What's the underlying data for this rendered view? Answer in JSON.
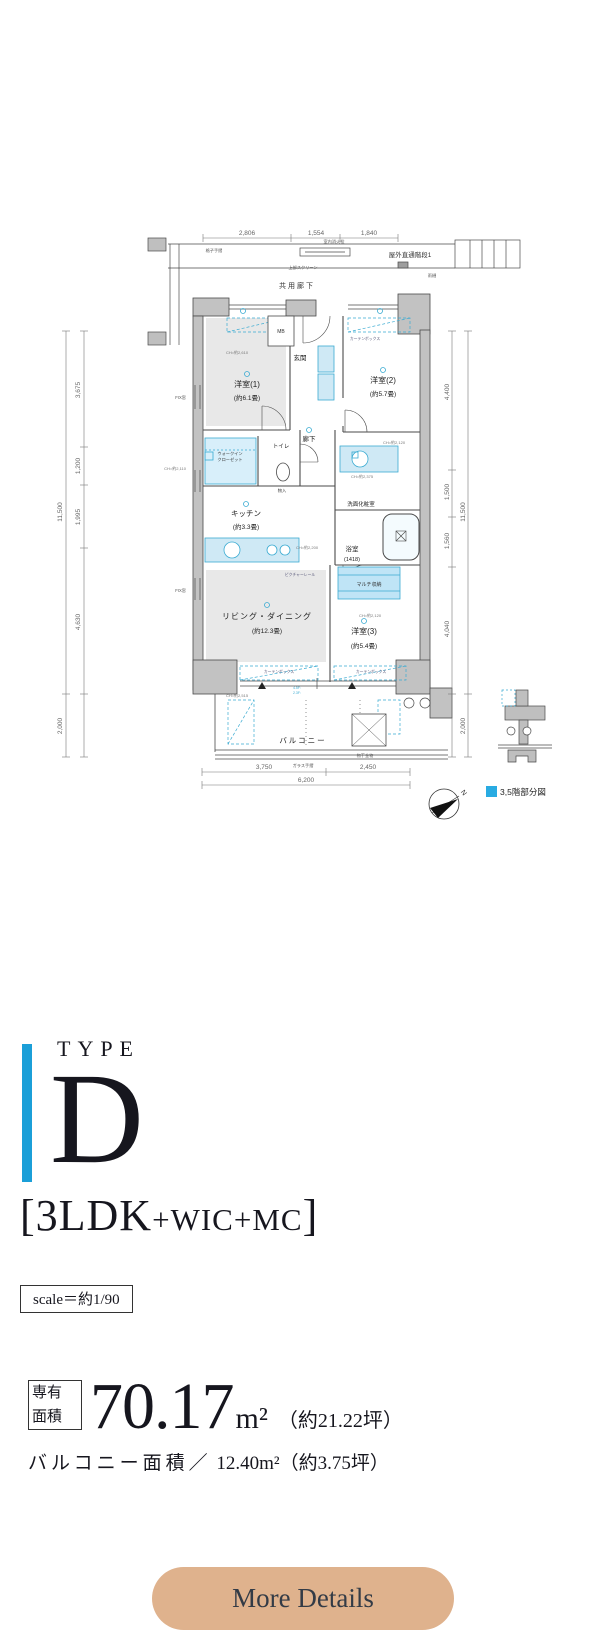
{
  "colors": {
    "accent": "#1b9fd8",
    "plan_cyan": "#3aabd2",
    "plan_cyan_fill": "#cfe9f5",
    "wall": "#c2c2c2",
    "wall_stroke": "#4a4a4a",
    "room_fill": "#e8e8e8",
    "dim_text": "#666666",
    "button": "#dfb28d",
    "button_text": "#333b46",
    "legend_square": "#29abe2"
  },
  "plan": {
    "texts": [
      {
        "x": 247,
        "y": 235,
        "t": "2,806",
        "s": 6.5,
        "c": "#666",
        "n": "dim-top-1"
      },
      {
        "x": 316,
        "y": 235,
        "t": "1,554",
        "s": 6.5,
        "c": "#666",
        "n": "dim-top-2"
      },
      {
        "x": 369,
        "y": 235,
        "t": "1,840",
        "s": 6.5,
        "c": "#666",
        "n": "dim-top-3"
      },
      {
        "x": 62,
        "y": 512,
        "t": "11,500",
        "s": 6.5,
        "c": "#666",
        "r": -90,
        "n": "dim-left-total"
      },
      {
        "x": 80,
        "y": 390,
        "t": "3,675",
        "s": 6.5,
        "c": "#666",
        "r": -90,
        "n": "dim-left-1"
      },
      {
        "x": 80,
        "y": 466,
        "t": "1,200",
        "s": 6.5,
        "c": "#666",
        "r": -90,
        "n": "dim-left-2"
      },
      {
        "x": 80,
        "y": 517,
        "t": "1,995",
        "s": 6.5,
        "c": "#666",
        "r": -90,
        "n": "dim-left-3"
      },
      {
        "x": 80,
        "y": 622,
        "t": "4,630",
        "s": 6.5,
        "c": "#666",
        "r": -90,
        "n": "dim-left-4"
      },
      {
        "x": 62,
        "y": 726,
        "t": "2,000",
        "s": 6.5,
        "c": "#666",
        "r": -90,
        "n": "dim-left-5"
      },
      {
        "x": 449,
        "y": 392,
        "t": "4,400",
        "s": 6.5,
        "c": "#666",
        "r": -90,
        "n": "dim-right-1"
      },
      {
        "x": 449,
        "y": 492,
        "t": "1,500",
        "s": 6.5,
        "c": "#666",
        "r": -90,
        "n": "dim-right-2"
      },
      {
        "x": 449,
        "y": 541,
        "t": "1,560",
        "s": 6.5,
        "c": "#666",
        "r": -90,
        "n": "dim-right-3"
      },
      {
        "x": 449,
        "y": 629,
        "t": "4,040",
        "s": 6.5,
        "c": "#666",
        "r": -90,
        "n": "dim-right-4"
      },
      {
        "x": 465,
        "y": 512,
        "t": "11,500",
        "s": 6.5,
        "c": "#666",
        "r": -90,
        "n": "dim-right-total"
      },
      {
        "x": 465,
        "y": 726,
        "t": "2,000",
        "s": 6.5,
        "c": "#666",
        "r": -90,
        "n": "dim-right-5"
      },
      {
        "x": 264,
        "y": 769,
        "t": "3,750",
        "s": 6.5,
        "c": "#666",
        "n": "dim-bottom-1"
      },
      {
        "x": 368,
        "y": 769,
        "t": "2,450",
        "s": 6.5,
        "c": "#666",
        "n": "dim-bottom-2"
      },
      {
        "x": 306,
        "y": 782,
        "t": "6,200",
        "s": 6.5,
        "c": "#666",
        "n": "dim-bottom-total"
      },
      {
        "x": 410,
        "y": 257,
        "t": "屋外直通階段1",
        "s": 6.5,
        "c": "#333",
        "n": "label-outdoor-stairs"
      },
      {
        "x": 297,
        "y": 288,
        "t": "共用廊下",
        "s": 7,
        "c": "#333",
        "ls": 2,
        "n": "label-common-corridor"
      },
      {
        "x": 303,
        "y": 269,
        "t": "上部スクリーン",
        "s": 4.2,
        "c": "#555",
        "n": "label-upper-screen"
      },
      {
        "x": 214,
        "y": 252,
        "t": "格子手摺",
        "s": 4.2,
        "c": "#555",
        "n": "label-lattice-rail"
      },
      {
        "x": 334,
        "y": 243,
        "t": "室内消火栓",
        "s": 4.2,
        "c": "#555",
        "n": "label-hydrant"
      },
      {
        "x": 432,
        "y": 277,
        "t": "雨樋",
        "s": 4.2,
        "c": "#555",
        "n": "label-gutter"
      },
      {
        "x": 281,
        "y": 333,
        "t": "MB",
        "s": 5,
        "c": "#333",
        "n": "label-mb"
      },
      {
        "x": 247,
        "y": 387,
        "t": "洋室(1)",
        "s": 8,
        "c": "#222",
        "n": "label-bedroom1"
      },
      {
        "x": 247,
        "y": 400,
        "t": "(約6.1畳)",
        "s": 6.5,
        "c": "#222",
        "n": "label-bedroom1-size"
      },
      {
        "x": 383,
        "y": 383,
        "t": "洋室(2)",
        "s": 8,
        "c": "#222",
        "n": "label-bedroom2"
      },
      {
        "x": 383,
        "y": 396,
        "t": "(約5.7畳)",
        "s": 6.5,
        "c": "#222",
        "n": "label-bedroom2-size"
      },
      {
        "x": 300,
        "y": 360,
        "t": "玄関",
        "s": 6.5,
        "c": "#222",
        "n": "label-entrance"
      },
      {
        "x": 309,
        "y": 441,
        "t": "廊下",
        "s": 6.5,
        "c": "#222",
        "n": "label-hallway"
      },
      {
        "x": 281,
        "y": 448,
        "t": "トイレ",
        "s": 5.5,
        "c": "#222",
        "n": "label-toilet"
      },
      {
        "x": 230,
        "y": 455,
        "t": "ウォークイン",
        "s": 4.2,
        "c": "#333",
        "n": "label-wic-1"
      },
      {
        "x": 230,
        "y": 461,
        "t": "クローゼット",
        "s": 4.2,
        "c": "#333",
        "n": "label-wic-2"
      },
      {
        "x": 282,
        "y": 492,
        "t": "物入",
        "s": 4.2,
        "c": "#333",
        "n": "label-storage"
      },
      {
        "x": 246,
        "y": 516,
        "t": "キッチン",
        "s": 7.5,
        "c": "#222",
        "n": "label-kitchen"
      },
      {
        "x": 246,
        "y": 529,
        "t": "(約3.3畳)",
        "s": 6.5,
        "c": "#222",
        "n": "label-kitchen-size"
      },
      {
        "x": 361,
        "y": 506,
        "t": "洗面化粧室",
        "s": 5.5,
        "c": "#222",
        "n": "label-washroom"
      },
      {
        "x": 352,
        "y": 551,
        "t": "浴室",
        "s": 6.5,
        "c": "#222",
        "n": "label-bath"
      },
      {
        "x": 352,
        "y": 561,
        "t": "(1418)",
        "s": 5.5,
        "c": "#222",
        "n": "label-bath-size"
      },
      {
        "x": 369,
        "y": 586,
        "t": "マルチ収納",
        "s": 5,
        "c": "#333",
        "n": "label-multi-closet"
      },
      {
        "x": 267,
        "y": 619,
        "t": "リビング・ダイニング",
        "s": 8,
        "c": "#222",
        "ls": 1,
        "n": "label-living-dining"
      },
      {
        "x": 267,
        "y": 633,
        "t": "(約12.3畳)",
        "s": 6.5,
        "c": "#222",
        "n": "label-living-size"
      },
      {
        "x": 364,
        "y": 634,
        "t": "洋室(3)",
        "s": 8,
        "c": "#222",
        "n": "label-bedroom3"
      },
      {
        "x": 364,
        "y": 648,
        "t": "(約5.4畳)",
        "s": 6.5,
        "c": "#222",
        "n": "label-bedroom3-size"
      },
      {
        "x": 303,
        "y": 743,
        "t": "バルコニー",
        "s": 7.5,
        "c": "#222",
        "ls": 2,
        "n": "label-balcony"
      },
      {
        "x": 365,
        "y": 340,
        "t": "カーテンボックス",
        "s": 3.8,
        "c": "#557",
        "n": "label-curtainbox-1"
      },
      {
        "x": 279,
        "y": 673,
        "t": "カーテンボックス",
        "s": 3.8,
        "c": "#557",
        "n": "label-curtainbox-2"
      },
      {
        "x": 371,
        "y": 673,
        "t": "カーテンボックス",
        "s": 3.8,
        "c": "#557",
        "n": "label-curtainbox-3"
      },
      {
        "x": 300,
        "y": 576,
        "t": "ピクチャーレール",
        "s": 3.8,
        "c": "#557",
        "n": "label-picture-rail"
      },
      {
        "x": 365,
        "y": 757,
        "t": "物干金物",
        "s": 4.2,
        "c": "#555",
        "n": "label-laundry-pole"
      },
      {
        "x": 303,
        "y": 767,
        "t": "ガラス手摺",
        "s": 4.2,
        "c": "#555",
        "n": "label-glass-rail"
      },
      {
        "x": 237,
        "y": 354,
        "t": "CH=約2,610",
        "s": 4,
        "c": "#777",
        "n": "label-ch-1"
      },
      {
        "x": 394,
        "y": 444,
        "t": "CH=約2,120",
        "s": 4,
        "c": "#777",
        "n": "label-ch-2"
      },
      {
        "x": 186,
        "y": 470,
        "t": "CH=約2,110",
        "s": 4,
        "c": "#777",
        "a": "end",
        "n": "label-ch-3"
      },
      {
        "x": 362,
        "y": 478,
        "t": "CH=約2,375",
        "s": 4,
        "c": "#777",
        "n": "label-ch-4"
      },
      {
        "x": 307,
        "y": 549,
        "t": "CH=約2,200",
        "s": 4,
        "c": "#777",
        "n": "label-ch-5"
      },
      {
        "x": 370,
        "y": 617,
        "t": "CH=約2,120",
        "s": 4,
        "c": "#777",
        "n": "label-ch-6"
      },
      {
        "x": 237,
        "y": 697,
        "t": "CH=約2,515",
        "s": 4,
        "c": "#777",
        "n": "label-ch-7"
      },
      {
        "x": 186,
        "y": 399,
        "t": "FIX窓",
        "s": 4.2,
        "c": "#555",
        "a": "end",
        "n": "label-fix-window-1"
      },
      {
        "x": 186,
        "y": 592,
        "t": "FIX窓",
        "s": 4.2,
        "c": "#555",
        "a": "end",
        "n": "label-fix-window-2"
      },
      {
        "x": 297,
        "y": 689,
        "t": "4.5F:",
        "s": 3.5,
        "c": "#3aabd2",
        "n": "label-floor-note-1"
      },
      {
        "x": 297,
        "y": 694,
        "t": "2.3F:",
        "s": 3.5,
        "c": "#3aabd2",
        "n": "label-floor-note-2"
      },
      {
        "x": 462,
        "y": 794,
        "t": "N",
        "s": 7,
        "c": "#333",
        "r": 55,
        "n": "north-label"
      },
      {
        "x": 500,
        "y": 795,
        "t": "3,5階部分図",
        "s": 8.5,
        "c": "#222",
        "a": "start",
        "n": "legend-label"
      }
    ]
  },
  "typebox": {
    "eyebrow": "TYPE",
    "letter": "D",
    "bracket_open": "[",
    "layout_main": "3LDK",
    "layout_sub": "+WIC+MC",
    "bracket_close": "]",
    "scale_note": "scale＝約1/90"
  },
  "area": {
    "label_line1": "専有",
    "label_line2": "面積",
    "value": "70.17",
    "unit": "m²",
    "tsubo": "（約21.22坪）",
    "balcony_label": "バルコニー面積／",
    "balcony_value": " 12.40m²",
    "balcony_tsubo": "（約3.75坪）"
  },
  "cta": {
    "label": "More Details"
  }
}
